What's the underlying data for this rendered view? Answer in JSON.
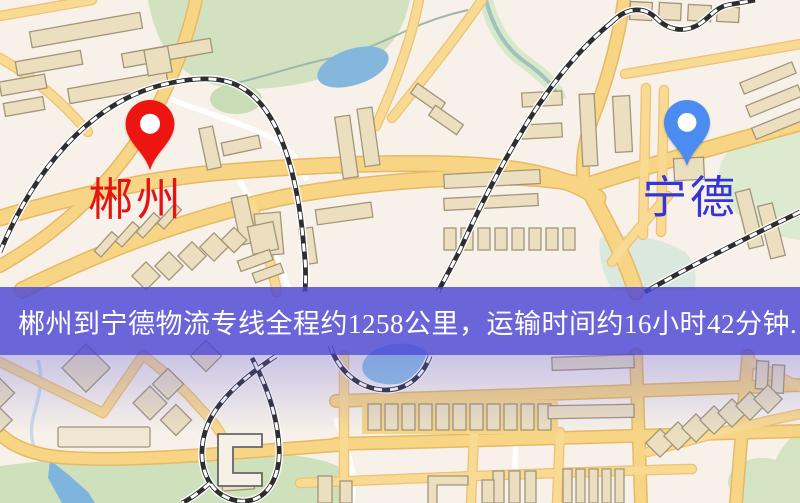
{
  "banner": {
    "text": "郴州到宁德物流专线全程约1258公里，运输时间约16小时42分钟.",
    "background": "rgba(74,70,213,0.82)",
    "text_color": "#ffffff"
  },
  "route": {
    "origin": "郴州",
    "destination": "宁德",
    "distance": "约1258公里",
    "duration": "约16小时42分钟"
  },
  "markers": {
    "origin": {
      "label": "郴州",
      "pin_color": "#ee1510",
      "label_color": "#e51410"
    },
    "destination": {
      "label": "宁德",
      "pin_color": "#4c8cf0",
      "label_color": "#3434d8"
    }
  },
  "map": {
    "kind": "street-map",
    "palette": {
      "background": "#f7f1e9",
      "road_fill": "#f7d585",
      "road_casing": "#e6b965",
      "park": "#d2e2c0",
      "water": "#8fc0e2",
      "building": "#ebdfc0",
      "railway": "#2e2e2e"
    }
  }
}
